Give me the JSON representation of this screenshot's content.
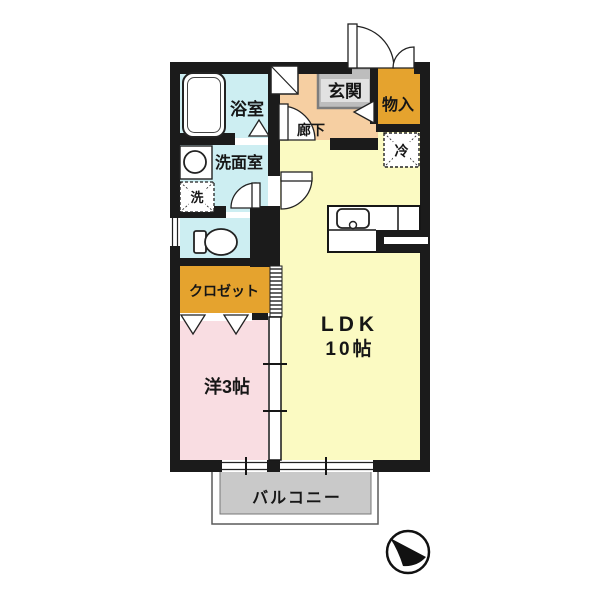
{
  "diagram": {
    "type": "apartment-floor-plan",
    "labels": {
      "bath": "浴室",
      "washroom": "洗面室",
      "laundry": "洗",
      "entry": "玄関",
      "corridor": "廊下",
      "storage": "物入",
      "refrigerator": "冷",
      "closet": "クロゼット",
      "ldk_name": "LDK",
      "ldk_size": "10帖",
      "western_room": "洋3帖",
      "balcony": "バルコニー"
    },
    "colors": {
      "wall": "#1b1b1b",
      "ldk": "#fbfac2",
      "corridor": "#f6cfa2",
      "wet_area": "#cdeef2",
      "western_room": "#f9dde2",
      "closet": "#e5a32e",
      "storage": "#e5a32e",
      "entry_floor": "#bdbdbd",
      "balcony": "#c9c9c9",
      "balcony_border": "#5a5a5a"
    }
  }
}
